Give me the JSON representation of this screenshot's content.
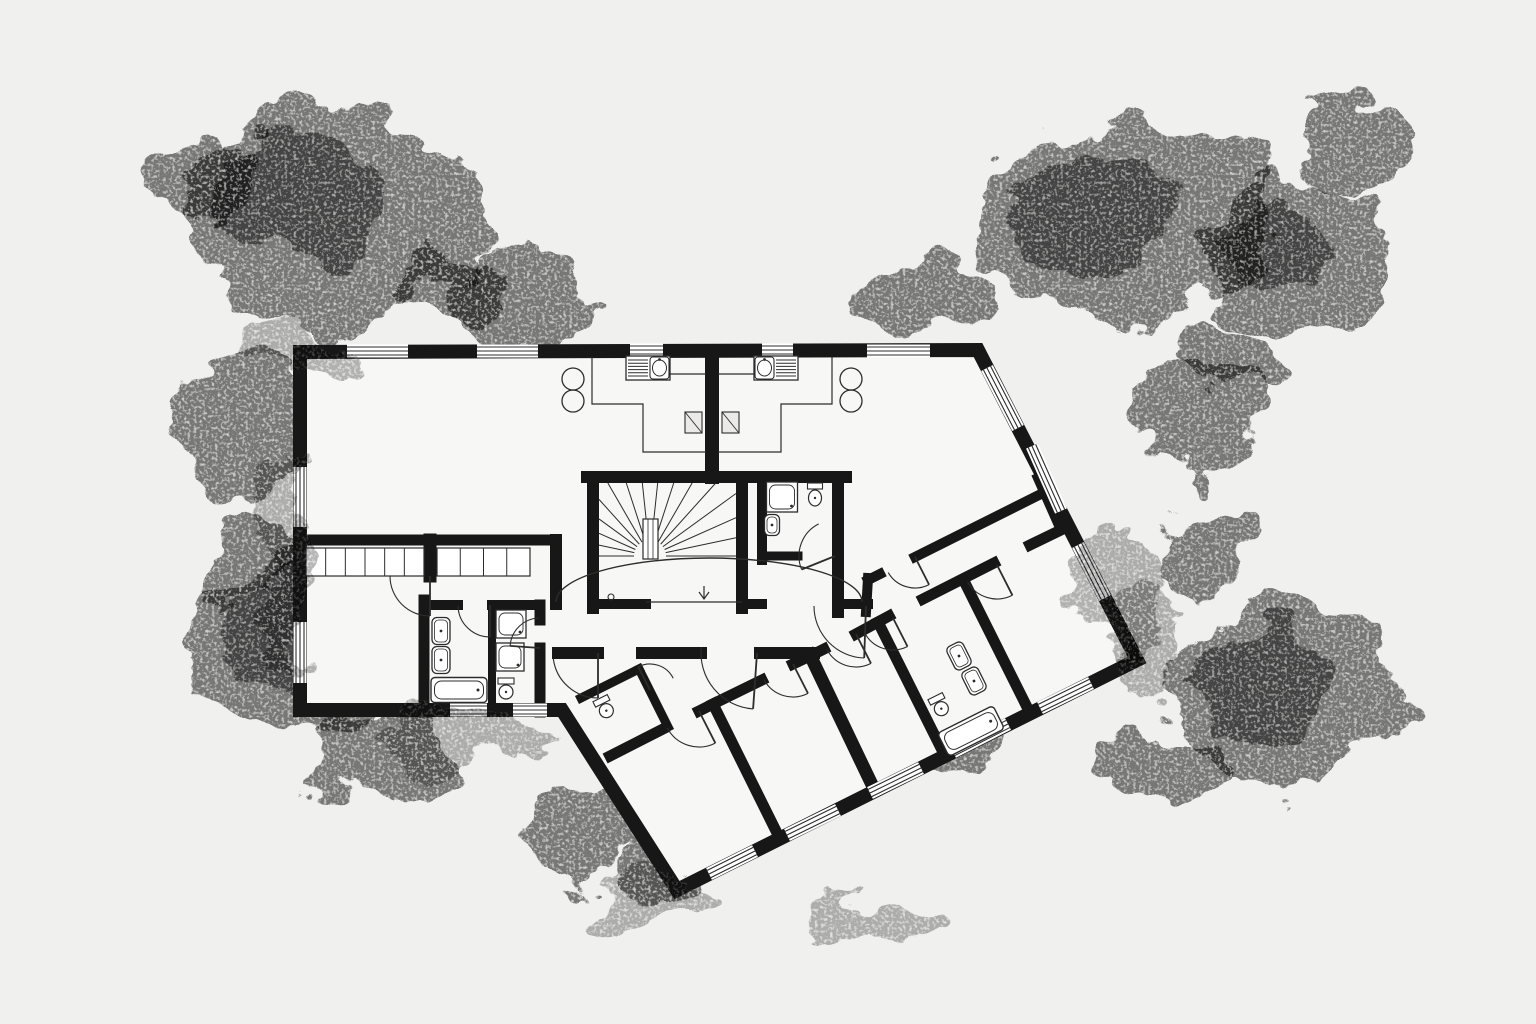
{
  "canvas": {
    "width": 1536,
    "height": 1024
  },
  "colors": {
    "background": "#f0f0ee",
    "paper": "#f7f7f5",
    "wall": "#171717",
    "thin": "#2c2c2c",
    "fixture": "#2c2c2c",
    "window_fill": "#ffffff",
    "foliage": "#bdbdbd",
    "foliage_dark": "#8e8e8e",
    "patch": "#cfcfcd"
  },
  "outline": {
    "points": [
      [
        300,
        352
      ],
      [
        978,
        350
      ],
      [
        1137,
        660
      ],
      [
        677,
        890
      ],
      [
        562,
        710
      ],
      [
        300,
        710
      ]
    ],
    "thickness": 14
  },
  "walls": [
    [
      712,
      351,
      712,
      477,
      14
    ],
    [
      587,
      477,
      846,
      477,
      12
    ],
    [
      593,
      477,
      593,
      608,
      12
    ],
    [
      742,
      477,
      742,
      608,
      12
    ],
    [
      762,
      477,
      762,
      560,
      10
    ],
    [
      838,
      477,
      838,
      612,
      12
    ],
    [
      762,
      556,
      798,
      556,
      9
    ],
    [
      593,
      604,
      646,
      604,
      10
    ],
    [
      742,
      604,
      762,
      604,
      10
    ],
    [
      838,
      604,
      868,
      604,
      10
    ],
    [
      558,
      653,
      598,
      653,
      12
    ],
    [
      642,
      653,
      701,
      653,
      12
    ],
    [
      760,
      653,
      814,
      653,
      12
    ],
    [
      810,
      655,
      875,
      791,
      13
    ],
    [
      780,
      839,
      713,
      704,
      11
    ],
    [
      945,
      756,
      878,
      622,
      11
    ],
    [
      1030,
      713,
      963,
      579,
      11
    ],
    [
      610,
      756,
      663,
      729,
      11
    ],
    [
      699,
      711,
      713,
      704,
      11
    ],
    [
      713,
      704,
      762,
      680,
      11
    ],
    [
      793,
      664,
      812,
      655,
      11
    ],
    [
      812,
      655,
      824,
      649,
      11
    ],
    [
      856,
      634,
      889,
      616,
      11
    ],
    [
      923,
      599,
      994,
      563,
      11
    ],
    [
      1030,
      545,
      1061,
      530,
      11
    ],
    [
      868,
      580,
      880,
      574,
      10
    ],
    [
      915,
      557,
      1043,
      493,
      10
    ],
    [
      1061,
      530,
      1038,
      478,
      10
    ],
    [
      866,
      612,
      868,
      578,
      10
    ],
    [
      581,
      698,
      639,
      669,
      9
    ],
    [
      668,
      727,
      639,
      669,
      9
    ],
    [
      306,
      540,
      424,
      540,
      11
    ],
    [
      437,
      540,
      556,
      540,
      11
    ],
    [
      430,
      540,
      430,
      576,
      13
    ],
    [
      556,
      540,
      556,
      604,
      12
    ],
    [
      424,
      600,
      424,
      712,
      11
    ],
    [
      424,
      605,
      458,
      605,
      10
    ],
    [
      492,
      605,
      540,
      605,
      10
    ],
    [
      492,
      605,
      492,
      712,
      8
    ],
    [
      540,
      605,
      540,
      620,
      11
    ],
    [
      540,
      648,
      540,
      712,
      11
    ]
  ],
  "windows": [
    [
      347,
      351,
      408,
      351
    ],
    [
      477,
      351,
      538,
      351
    ],
    [
      630,
      350,
      663,
      350
    ],
    [
      762,
      350,
      793,
      350
    ],
    [
      867,
      351,
      930,
      351
    ],
    [
      300,
      467,
      300,
      527
    ],
    [
      300,
      622,
      300,
      683
    ],
    [
      987,
      368,
      1018,
      428
    ],
    [
      1032,
      446,
      1061,
      511
    ],
    [
      1078,
      545,
      1105,
      598
    ],
    [
      1091,
      683,
      1040,
      708
    ],
    [
      1008,
      724,
      953,
      752
    ],
    [
      921,
      768,
      870,
      793
    ],
    [
      838,
      810,
      787,
      835
    ],
    [
      755,
      851,
      709,
      874
    ],
    [
      450,
      710,
      487,
      710
    ],
    [
      513,
      710,
      547,
      710
    ]
  ],
  "doors": [
    [
      430,
      576,
      40,
      90,
      180
    ],
    [
      490,
      605,
      32,
      90,
      178
    ],
    [
      540,
      648,
      30,
      184,
      268
    ],
    [
      835,
      556,
      36,
      158,
      243
    ],
    [
      866,
      606,
      52,
      92,
      180
    ],
    [
      598,
      653,
      45,
      90,
      173
    ],
    [
      757,
      653,
      56,
      94,
      186
    ],
    [
      699,
      711,
      36,
      63,
      152
    ],
    [
      793,
      664,
      33,
      63,
      152
    ],
    [
      856,
      634,
      33,
      63,
      152
    ],
    [
      893,
      618,
      32,
      63,
      150
    ],
    [
      997,
      565,
      34,
      63,
      150
    ],
    [
      915,
      557,
      31,
      63,
      150
    ],
    [
      650,
      690,
      26,
      243,
      333
    ]
  ],
  "arch": {
    "x1": 556,
    "y1": 602,
    "x2": 862,
    "y2": 602,
    "ry": 44
  },
  "thin_lines": [
    [
      [
        646,
        602
      ],
      [
        742,
        602
      ]
    ],
    [
      [
        592,
        357
      ],
      [
        592,
        404
      ],
      [
        643,
        404
      ],
      [
        643,
        452
      ],
      [
        706,
        452
      ]
    ],
    [
      [
        670,
        374
      ],
      [
        706,
        374
      ]
    ],
    [
      [
        832,
        357
      ],
      [
        832,
        404
      ],
      [
        781,
        404
      ],
      [
        781,
        452
      ],
      [
        718,
        452
      ]
    ],
    [
      [
        754,
        374
      ],
      [
        718,
        374
      ]
    ]
  ],
  "wardrobes": [
    {
      "x": 306,
      "y": 548,
      "w": 118,
      "h": 28,
      "n": 6
    },
    {
      "x": 437,
      "y": 548,
      "w": 93,
      "h": 28,
      "n": 4
    }
  ],
  "stairs": {
    "box": [
      599,
      483,
      736,
      600
    ],
    "center": [
      650,
      556
    ],
    "r0": 16,
    "rays": 15,
    "newel": [
      643,
      519,
      15,
      40
    ],
    "start_circle": [
      611,
      597
    ],
    "arrow": [
      704,
      586,
      704,
      599
    ]
  },
  "kitchens": [
    {
      "unit": [
        626,
        356,
        44,
        24
      ],
      "hatch": [
        628,
        358,
        20,
        20
      ],
      "sink": [
        650,
        357,
        19,
        22
      ]
    },
    {
      "unit": [
        754,
        356,
        44,
        24
      ],
      "hatch": [
        776,
        358,
        20,
        20
      ],
      "sink": [
        755,
        357,
        19,
        22
      ]
    }
  ],
  "ducts": [
    [
      685,
      412,
      17,
      21
    ],
    [
      722,
      412,
      17,
      21
    ]
  ],
  "circles": [
    [
      573,
      379,
      11
    ],
    [
      573,
      401,
      11
    ],
    [
      851,
      379,
      11
    ],
    [
      851,
      401,
      11
    ]
  ],
  "fixtures": {
    "sinks": [
      [
        441,
        631,
        18,
        27,
        0
      ],
      [
        441,
        660,
        18,
        27,
        0
      ],
      [
        772,
        525,
        15,
        21,
        0
      ],
      [
        959,
        656,
        18,
        26,
        -26.57
      ],
      [
        974,
        681,
        18,
        26,
        -26.57
      ]
    ],
    "tubs": [
      [
        459,
        690,
        56,
        25,
        0
      ],
      [
        971,
        731,
        62,
        26,
        -26.57
      ]
    ],
    "showers": [
      [
        782,
        497,
        31,
        30,
        0
      ],
      [
        511,
        624,
        30,
        28,
        0
      ],
      [
        510,
        657,
        28,
        28,
        0
      ]
    ],
    "toilets": [
      [
        815,
        495,
        15,
        24,
        0
      ],
      [
        506,
        689,
        16,
        22,
        0
      ],
      [
        605,
        708,
        16,
        22,
        -26.57
      ],
      [
        940,
        706,
        16,
        22,
        -26.57
      ]
    ]
  },
  "trees": [
    [
      330,
      215,
      155,
      110,
      1
    ],
    [
      515,
      300,
      70,
      52,
      0
    ],
    [
      245,
      430,
      62,
      72,
      0
    ],
    [
      300,
      655,
      100,
      92,
      1
    ],
    [
      385,
      755,
      68,
      50,
      0
    ],
    [
      588,
      825,
      62,
      46,
      0
    ],
    [
      665,
      878,
      44,
      32,
      0
    ],
    [
      925,
      298,
      68,
      44,
      0
    ],
    [
      1125,
      222,
      150,
      100,
      1
    ],
    [
      1298,
      258,
      92,
      74,
      1
    ],
    [
      1196,
      424,
      64,
      52,
      0
    ],
    [
      1206,
      545,
      54,
      44,
      0
    ],
    [
      1285,
      698,
      115,
      92,
      1
    ],
    [
      1168,
      765,
      58,
      42,
      0
    ],
    [
      952,
      735,
      48,
      36,
      0
    ],
    [
      1352,
      148,
      62,
      46,
      0
    ],
    [
      198,
      178,
      62,
      48,
      0
    ],
    [
      448,
      298,
      52,
      38,
      0
    ],
    [
      250,
      560,
      40,
      45,
      0
    ],
    [
      1230,
      360,
      45,
      40,
      0
    ]
  ],
  "patches": [
    [
      283,
      555,
      26,
      110
    ],
    [
      470,
      742,
      95,
      28
    ],
    [
      640,
      905,
      80,
      26
    ],
    [
      1120,
      600,
      45,
      70
    ],
    [
      295,
      350,
      55,
      28
    ],
    [
      1145,
      640,
      40,
      60
    ],
    [
      870,
      915,
      70,
      25
    ]
  ]
}
